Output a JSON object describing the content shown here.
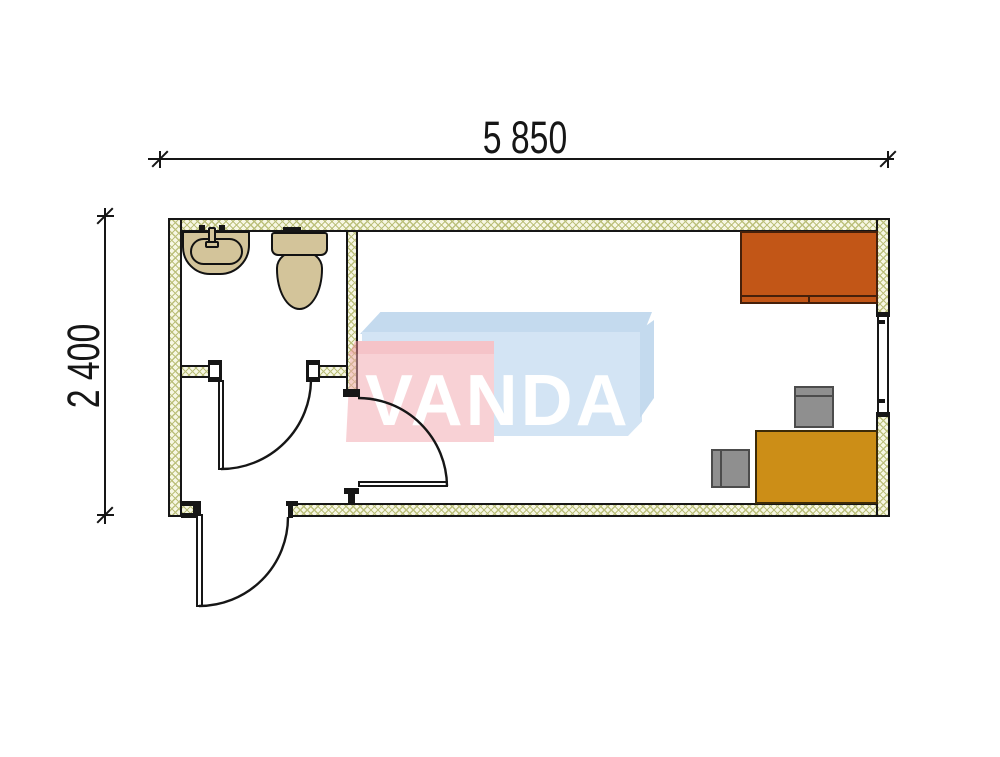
{
  "dimensions": {
    "width_label": "5 850",
    "height_label": "2 400"
  },
  "watermark": {
    "text": "VANDA"
  },
  "colors": {
    "line_black": "#161616",
    "wall_hatch_bg": "#f7f7e4",
    "wall_hatch_line": "#bcc07c",
    "fixture_tan": "#d3c49a",
    "fixture_outline": "#121212",
    "cabinet_orange": "#c25617",
    "cabinet_outline": "#46200a",
    "desk_gold": "#cc8e17",
    "desk_outline": "#3c2b08",
    "chair_gray": "#8f8f8f",
    "chair_outline": "#4c4c4c",
    "watermark_pink": "#f2a9b0",
    "watermark_pink_dark": "#ec8d97",
    "watermark_blue": "#abcdea",
    "watermark_blue_dark": "#90badf",
    "watermark_text": "#ffffff"
  },
  "plan_objects": {
    "fixtures": [
      "sink",
      "toilet"
    ],
    "furniture": [
      "cabinet",
      "desk",
      "chair",
      "chair"
    ],
    "openings": [
      "entry-door",
      "hall-door",
      "bathroom-door",
      "window"
    ]
  }
}
